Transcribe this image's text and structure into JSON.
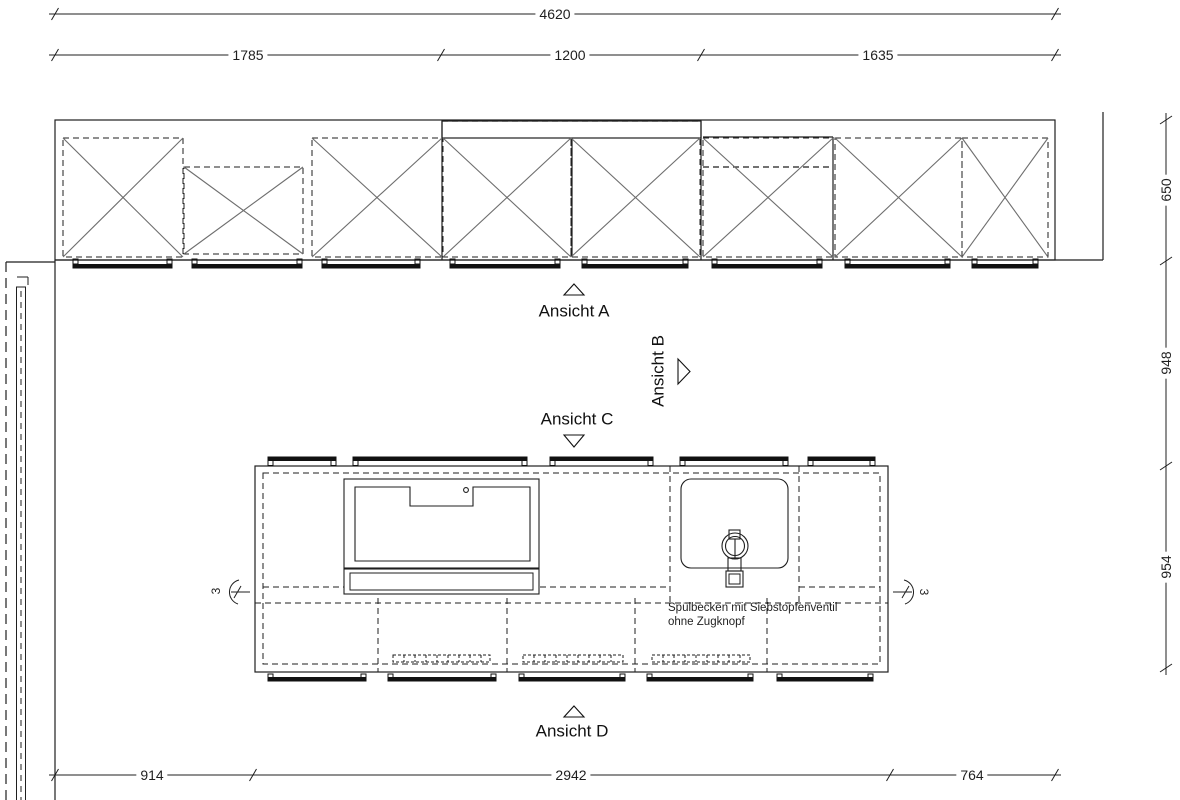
{
  "dimensions": {
    "top_total": "4620",
    "top_segments": [
      "1785",
      "1200",
      "1635"
    ],
    "right_segments": [
      "650",
      "948",
      "954"
    ],
    "bottom_segments": [
      "914",
      "2942",
      "764"
    ]
  },
  "views": {
    "a": "Ansicht A",
    "b": "Ansicht B",
    "c": "Ansicht C",
    "d": "Ansicht D"
  },
  "notes": {
    "sink_line1": "Spülbecken mit Siebstopfenventil",
    "sink_line2": "ohne Zugknopf"
  },
  "joints": {
    "left": "3",
    "right": "3"
  },
  "colors": {
    "line": "#1f1f1f",
    "diagonal": "#6e6e6e",
    "background": "#ffffff"
  }
}
